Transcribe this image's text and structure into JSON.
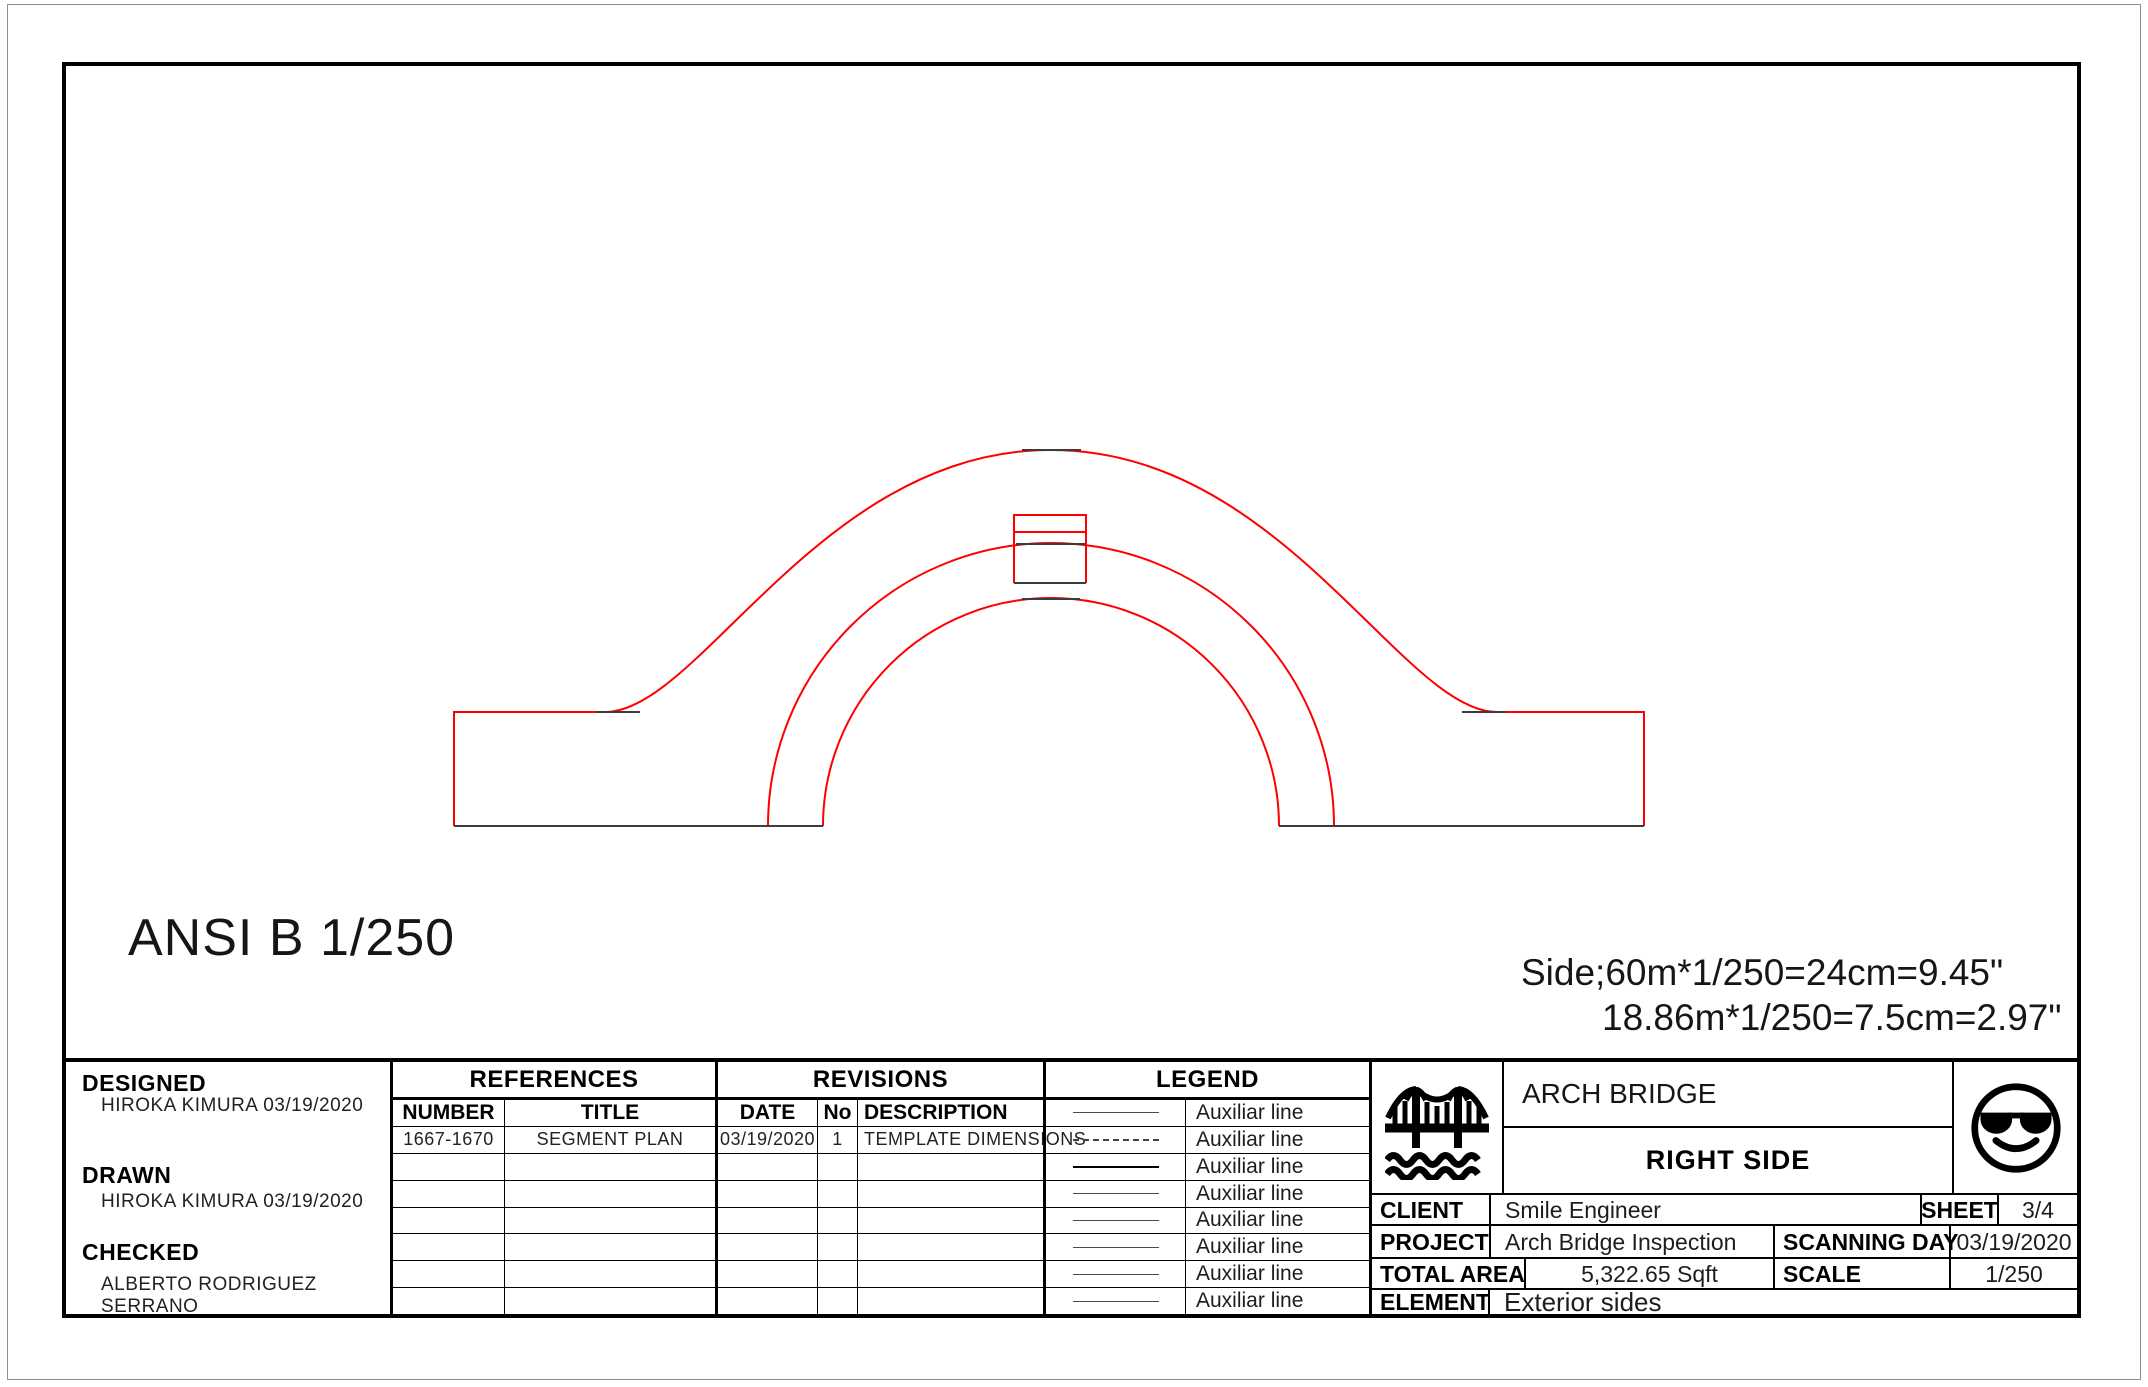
{
  "colors": {
    "line_red": "#fe0000",
    "line_dark": "#3c3c3c",
    "border_black": "#000000"
  },
  "notes": {
    "format": "ANSI B 1/250",
    "scale_line1": "Side;60m*1/250=24cm=9.45\"",
    "scale_line2": "18.86m*1/250=7.5cm=2.97\""
  },
  "designed": {
    "label": "DESIGNED",
    "value": "HIROKA KIMURA 03/19/2020"
  },
  "drawn": {
    "label": "DRAWN",
    "value": "HIROKA KIMURA 03/19/2020"
  },
  "checked": {
    "label": "CHECKED",
    "value": "ALBERTO RODRIGUEZ SERRANO"
  },
  "references": {
    "title": "REFERENCES",
    "columns": {
      "number": "NUMBER",
      "title": "TITLE"
    },
    "rows": [
      {
        "number": "1667-1670",
        "title": "SEGMENT PLAN"
      }
    ]
  },
  "revisions": {
    "title": "REVISIONS",
    "columns": {
      "date": "DATE",
      "no": "No",
      "description": "DESCRIPTION"
    },
    "rows": [
      {
        "date": "03/19/2020",
        "no": "1",
        "description": "TEMPLATE DIMENSIONS"
      }
    ]
  },
  "legend": {
    "title": "LEGEND",
    "items": [
      {
        "style": "solid",
        "label": "Auxiliar line"
      },
      {
        "style": "dashed",
        "label": "Auxiliar line"
      },
      {
        "style": "solid-bold",
        "label": "Auxiliar line"
      },
      {
        "style": "solid",
        "label": "Auxiliar line"
      },
      {
        "style": "solid",
        "label": "Auxiliar line"
      },
      {
        "style": "solid",
        "label": "Auxiliar line"
      },
      {
        "style": "solid",
        "label": "Auxiliar line"
      },
      {
        "style": "solid",
        "label": "Auxiliar line"
      }
    ]
  },
  "title_area": {
    "project_name": "ARCH BRIDGE",
    "view_name": "RIGHT SIDE",
    "icons": [
      "bridge-icon",
      "smiley-sunglasses-icon"
    ]
  },
  "info": {
    "client_label": "CLIENT",
    "client": "Smile Engineer",
    "sheet_label": "SHEET",
    "sheet": "3/4",
    "project_label": "PROJECT",
    "project": "Arch Bridge Inspection",
    "scanning_day_label": "SCANNING DAY",
    "scanning_day": "03/19/2020",
    "total_area_label": "TOTAL AREA",
    "total_area": "5,322.65 Sqft",
    "scale_label": "SCALE",
    "scale": "1/250",
    "element_label": "ELEMENT",
    "element": "Exterior sides"
  }
}
